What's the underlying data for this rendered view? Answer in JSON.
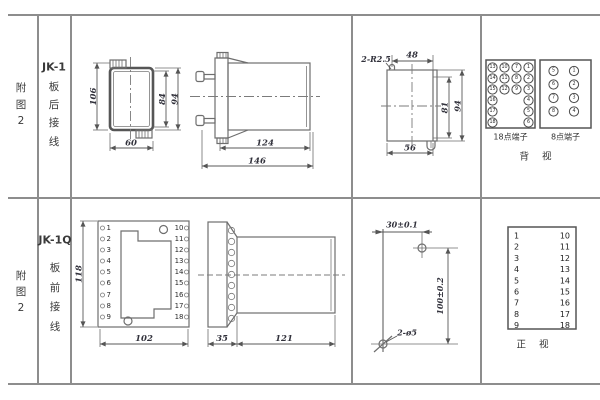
{
  "page": {
    "background": "#ffffff",
    "grid_color": "#8d8d8d",
    "line_color": "#6e6e6e",
    "dim_text_color": "#32323c"
  },
  "row1": {
    "figure_no": {
      "l1": "附",
      "l2": "图",
      "l3": "2"
    },
    "model": {
      "name": "JK-1",
      "w1": "板",
      "w2": "后",
      "w3": "接",
      "w4": "线"
    },
    "front": {
      "height": "106",
      "inner_height": "84",
      "outer_height": "94",
      "width": "60"
    },
    "side": {
      "body_len": "124",
      "total_len": "146"
    },
    "cutout": {
      "radius_note": "2-R2.5",
      "top_width": "48",
      "inner_height": "81",
      "outer_height": "94",
      "bottom_width": "56"
    },
    "t18": {
      "label": "18点端子",
      "col1": [
        "13",
        "14",
        "15",
        "16",
        "17",
        "18"
      ],
      "col2": [
        "10",
        "11",
        "12"
      ],
      "col3": [
        "7",
        "8",
        "9"
      ],
      "col4": [
        "1",
        "2",
        "3",
        "4",
        "5",
        "6"
      ]
    },
    "t8": {
      "label": "8点端子",
      "left": [
        "5",
        "6",
        "7",
        "8"
      ],
      "right": [
        "1",
        "2",
        "3",
        "4"
      ]
    },
    "view_label": "背 视"
  },
  "row2": {
    "figure_no": {
      "l1": "附",
      "l2": "图",
      "l3": "2"
    },
    "model": {
      "name": "JK-1Q",
      "w1": "板",
      "w2": "前",
      "w3": "接",
      "w4": "线"
    },
    "front": {
      "height": "118",
      "width": "102",
      "left_terminals": [
        "1",
        "2",
        "3",
        "4",
        "5",
        "6",
        "7",
        "8",
        "9"
      ],
      "right_terminals": [
        "10",
        "11",
        "12",
        "13",
        "14",
        "15",
        "16",
        "17",
        "18"
      ]
    },
    "side": {
      "flange_len": "35",
      "body_len": "121"
    },
    "drill": {
      "hole_spacing_x": "30±0.1",
      "hole_spacing_y": "100±0.2",
      "holes_note": "2-ø5"
    },
    "table": {
      "left": [
        "1",
        "2",
        "3",
        "4",
        "5",
        "6",
        "7",
        "8",
        "9"
      ],
      "right": [
        "10",
        "11",
        "12",
        "13",
        "14",
        "15",
        "16",
        "17",
        "18"
      ],
      "view_label": "正 视"
    }
  }
}
